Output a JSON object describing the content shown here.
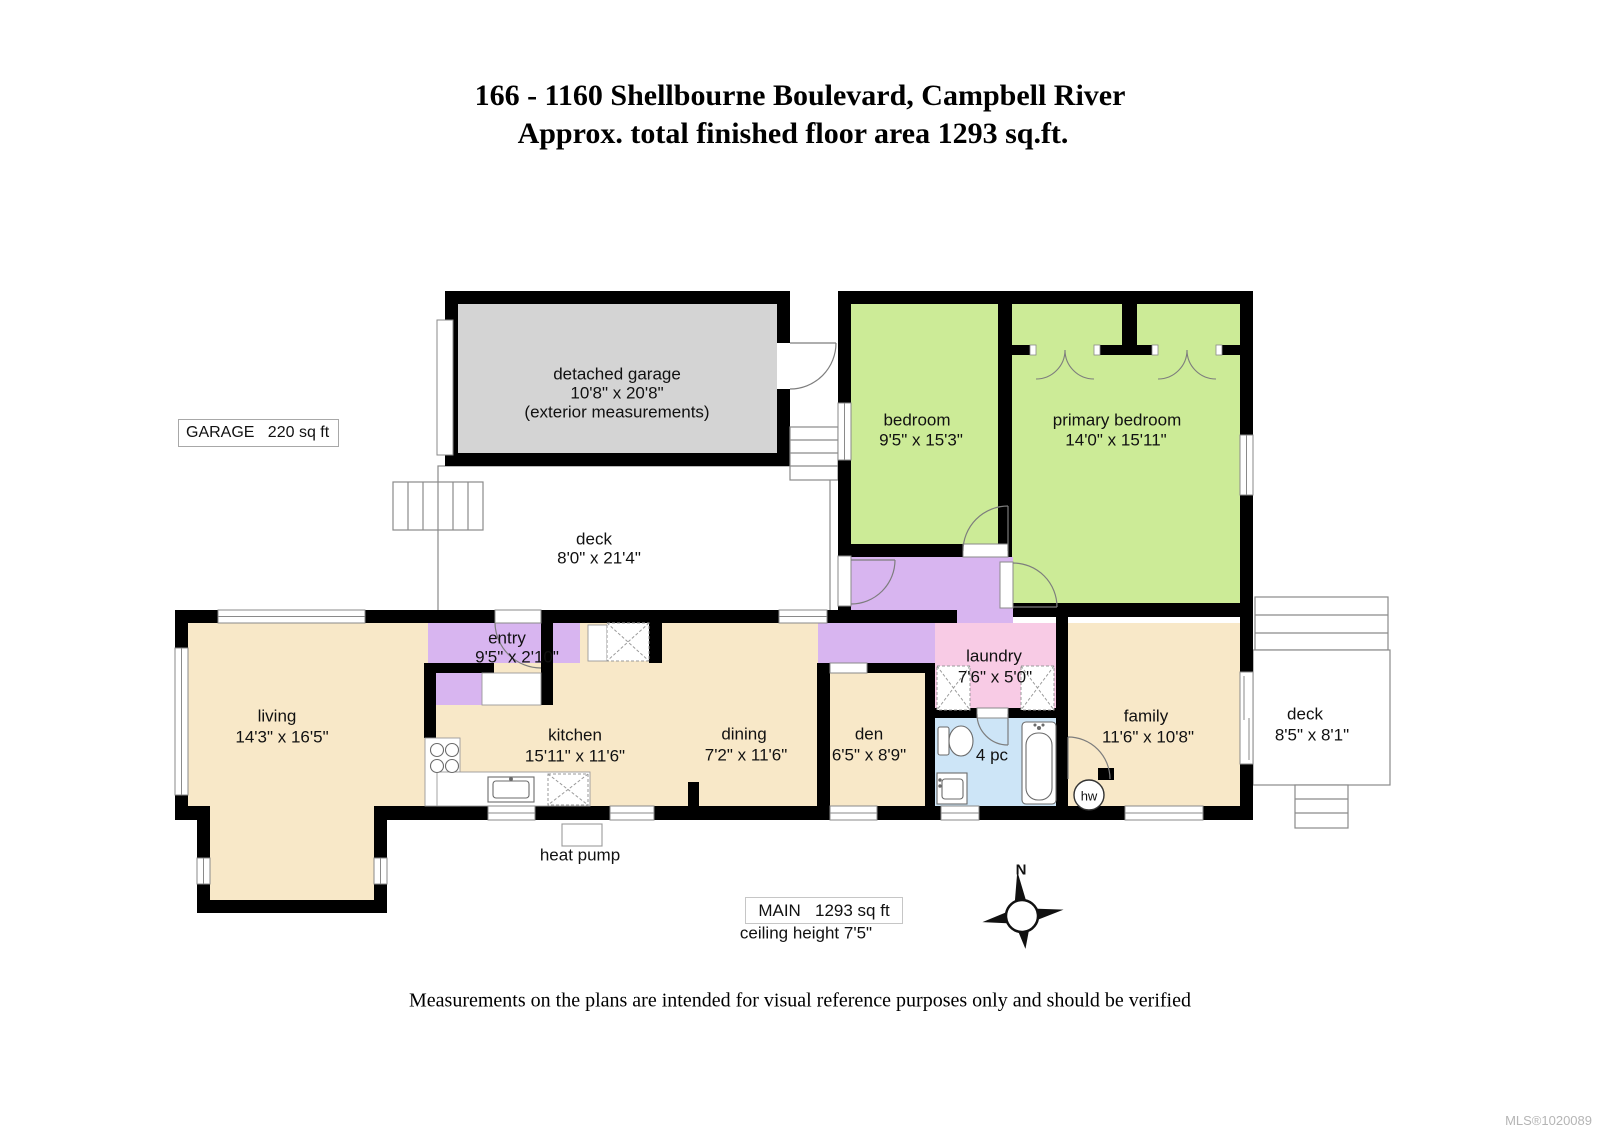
{
  "title": {
    "line1": "166 - 1160 Shellbourne Boulevard, Campbell River",
    "line2": "Approx. total finished floor area 1293 sq.ft."
  },
  "rooms": [
    {
      "id": "detached-garage",
      "name": "detached garage",
      "dims": "10'8\" x 20'8\"",
      "note": "(exterior measurements)"
    },
    {
      "id": "deck-upper",
      "name": "deck",
      "dims": "8'0\" x 21'4\""
    },
    {
      "id": "bedroom",
      "name": "bedroom",
      "dims": "9'5\" x 15'3\""
    },
    {
      "id": "primary-bedroom",
      "name": "primary bedroom",
      "dims": "14'0\" x 15'11\""
    },
    {
      "id": "living",
      "name": "living",
      "dims": "14'3\" x 16'5\""
    },
    {
      "id": "entry",
      "name": "entry",
      "dims": "9'5\" x 2'10\""
    },
    {
      "id": "kitchen",
      "name": "kitchen",
      "dims": "15'11\" x 11'6\""
    },
    {
      "id": "dining",
      "name": "dining",
      "dims": "7'2\" x 11'6\""
    },
    {
      "id": "den",
      "name": "den",
      "dims": "6'5\" x 8'9\""
    },
    {
      "id": "laundry",
      "name": "laundry",
      "dims": "7'6\" x 5'0\""
    },
    {
      "id": "bathroom",
      "name": "4 pc",
      "dims": ""
    },
    {
      "id": "family",
      "name": "family",
      "dims": "11'6\" x 10'8\""
    },
    {
      "id": "deck-right",
      "name": "deck",
      "dims": "8'5\" x 8'1\""
    }
  ],
  "labels": {
    "garage_box": "GARAGE   220 sq ft",
    "main_box": "MAIN   1293 sq ft",
    "ceiling": "ceiling height 7'5\"",
    "heat_pump": "heat pump",
    "hot_water": "hw",
    "north": "N",
    "footer": "Measurements on the plans are intended for visual reference purposes only and should be verified",
    "mls": "MLS®1020089"
  },
  "colors": {
    "wall": "#000000",
    "floor_tan": "#F8E8C8",
    "bedroom_green": "#CCEB97",
    "hall_purple": "#D8B5F0",
    "laundry_pink": "#F8CBE5",
    "bath_blue": "#CDE5F7",
    "garage_gray": "#D4D4D4"
  }
}
